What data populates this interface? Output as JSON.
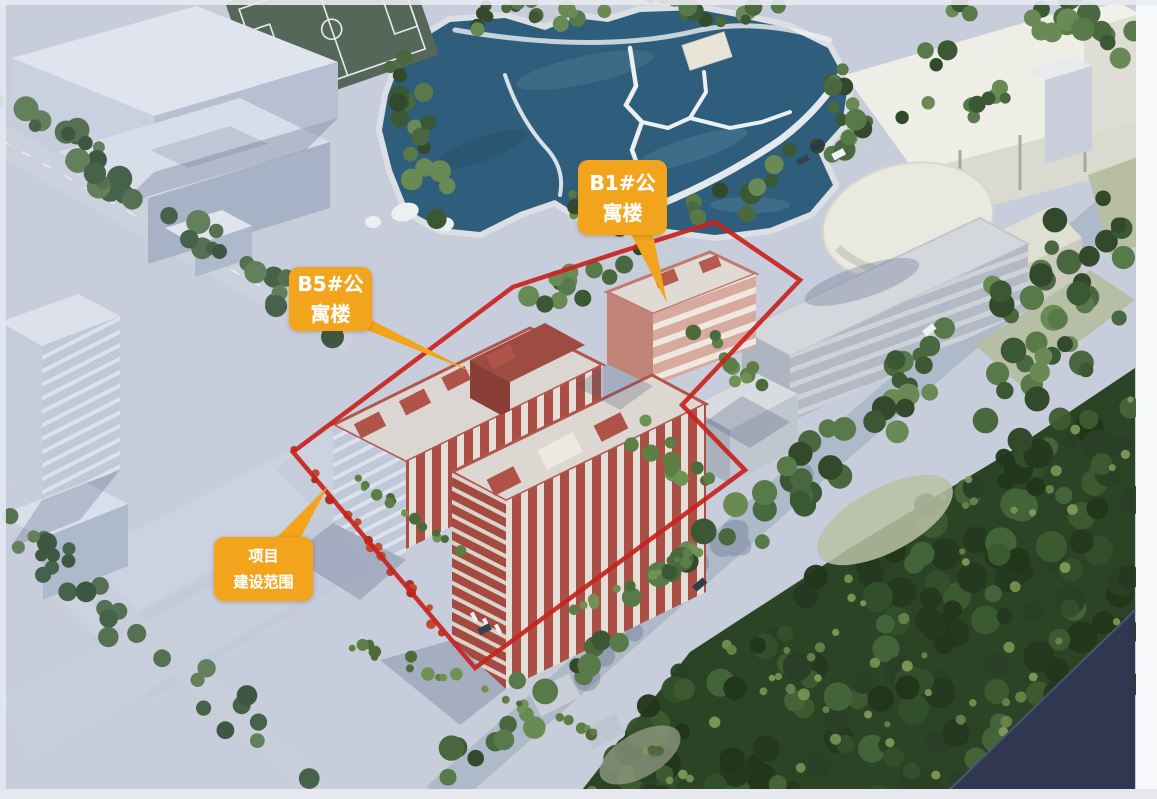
{
  "annotations": {
    "b1": {
      "line1": "B1#公",
      "line2": "寓楼"
    },
    "b5": {
      "line1": "B5#公",
      "line2": "寓楼"
    },
    "scope": {
      "line1": "项目",
      "line2": "建设范围"
    }
  },
  "colors": {
    "label_bg": "#F2A41C",
    "label_text": "#FFFFFF",
    "boundary_red": "#C8231E",
    "lake_water": "#2E5E7C",
    "forest": "#2C4426",
    "sports_field": "#556759"
  }
}
